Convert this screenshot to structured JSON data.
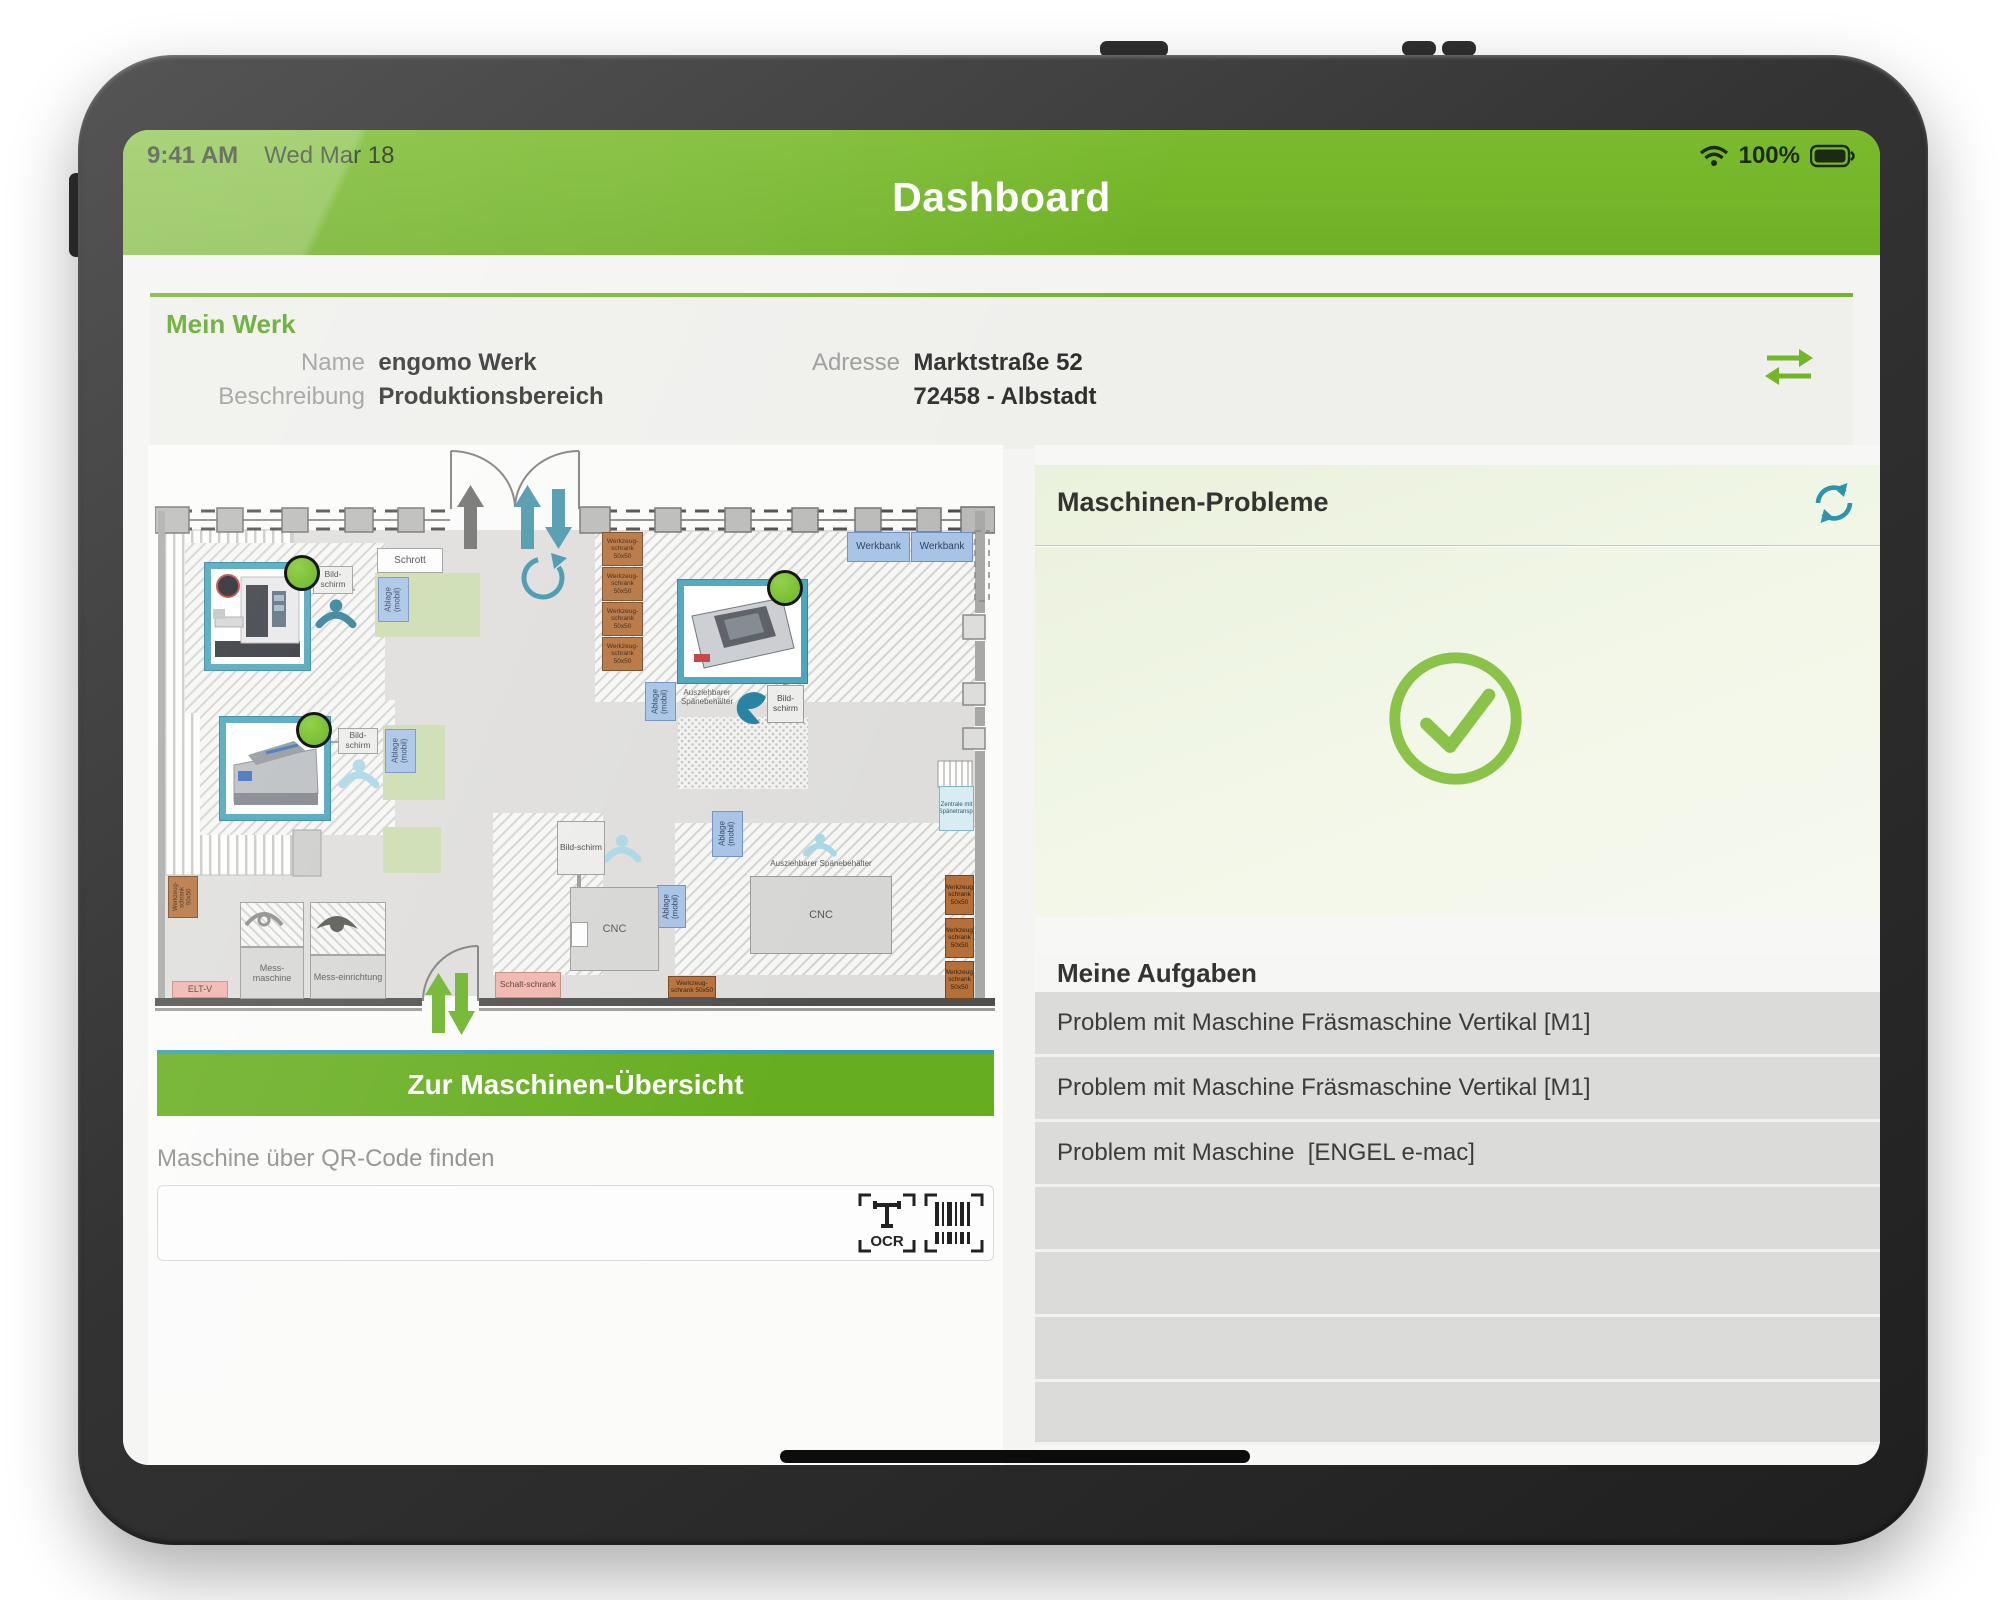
{
  "status_bar": {
    "time": "9:41 AM",
    "date": "Wed Mar 18",
    "battery_percent": "100%"
  },
  "header": {
    "title": "Dashboard"
  },
  "mein_werk": {
    "title": "Mein Werk",
    "name_label": "Name",
    "name_value": "engomo Werk",
    "beschreibung_label": "Beschreibung",
    "beschreibung_value": "Produktionsbereich",
    "adresse_label": "Adresse",
    "adresse_value": "Marktstraße 52",
    "adresse_value2": "72458 - Albstadt"
  },
  "floorplan": {
    "labels": {
      "schrott": "Schrott",
      "bildschirm": "Bild-schirm",
      "ablage": "Ablage (mobil)",
      "werkbank": "Werkbank",
      "werkzeugschrank": "Werkzeug-schrank 50x50",
      "cnc": "CNC",
      "spaenebehaelter": "Ausziehbarer Spänebehälter",
      "messmaschine": "Mess-maschine",
      "messeinrichtung": "Mess-einrichtung",
      "eltv": "ELT-V",
      "schaltschrank": "Schalt-schrank",
      "zentrale": "Zentrale mit Spänetransp."
    }
  },
  "overview_button": {
    "label": "Zur Maschinen-Übersicht"
  },
  "qr": {
    "label": "Maschine über QR-Code finden",
    "ocr": "OCR"
  },
  "problems": {
    "title": "Maschinen-Probleme"
  },
  "tasks": {
    "title": "Meine Aufgaben",
    "items": [
      "Problem mit Maschine Fräsmaschine Vertikal [M1]",
      "Problem mit Maschine Fräsmaschine Vertikal [M1]",
      "Problem mit Maschine  [ENGEL e-mac]"
    ]
  },
  "colors": {
    "brand_green": "#74b62a",
    "check_green": "#8bc34a",
    "teal": "#2f93ab"
  }
}
